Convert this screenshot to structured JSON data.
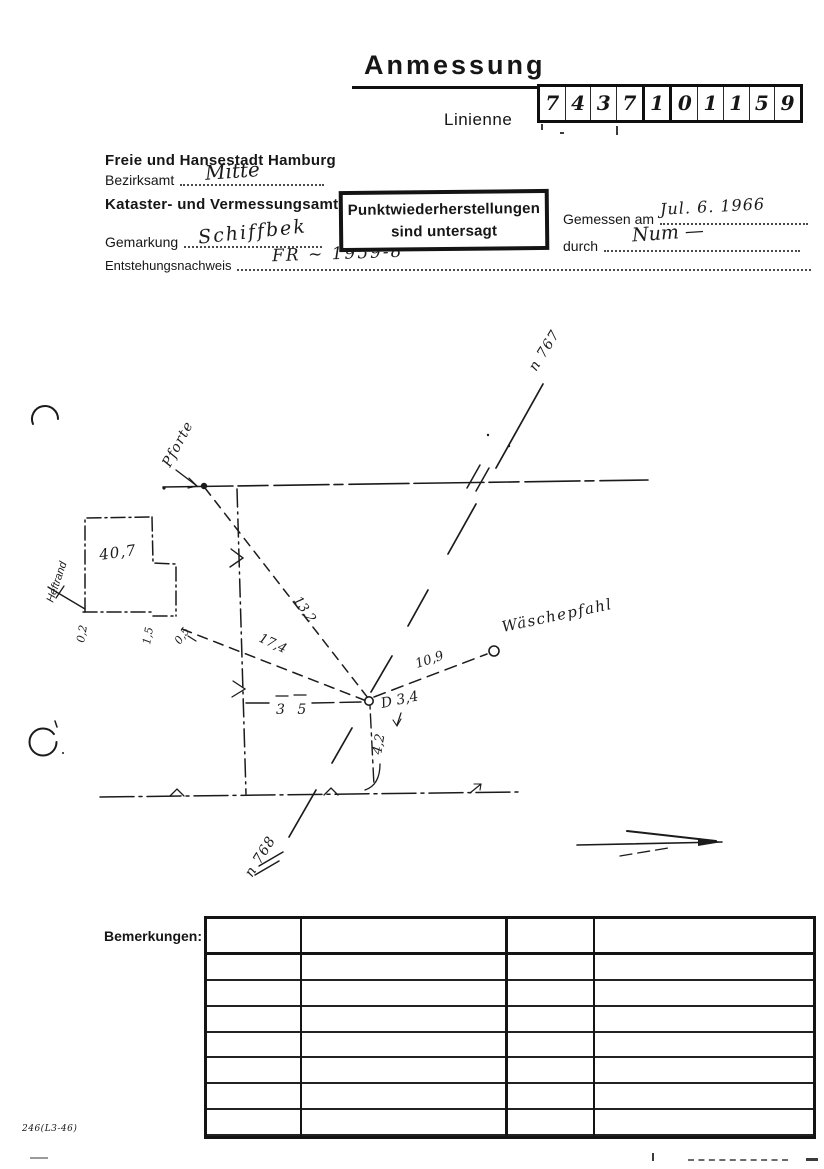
{
  "page": {
    "title": "Anmessung",
    "linien_label": "Linienne",
    "form_number": "246(L3-46)"
  },
  "point_number": {
    "digits": [
      "7",
      "4",
      "3",
      "7",
      "1",
      "0",
      "1",
      "1",
      "5",
      "9"
    ]
  },
  "header": {
    "city": "Freie und Hansestadt Hamburg",
    "bezirksamt": {
      "label": "Bezirksamt",
      "value": "Mitte"
    },
    "amt": "Kataster- und Vermessungsamt",
    "gemarkung": {
      "label": "Gemarkung",
      "value": "Schiffbek"
    },
    "entstehungsnachweis": {
      "label": "Entstehungsnachweis",
      "value": "FR ~ 1959-8"
    },
    "gemessen_am": {
      "label": "Gemessen am",
      "value": "Jul. 6. 1966"
    },
    "durch": {
      "label": "durch",
      "value": "Num —"
    },
    "stamp": {
      "line1": "Punktwiederherstellungen",
      "line2": "sind untersagt"
    }
  },
  "sketch": {
    "labels": {
      "pforte": "Pforte",
      "heftrand": "Heftrand",
      "line_upper": "n 767",
      "line_lower": "n 768",
      "waeschepfahl": "Wäschepfahl",
      "building_area": "40,7",
      "point_label": "D 3,4"
    },
    "measurements": {
      "dist_gate": "13,2",
      "dist_corner": "17,4",
      "dist_offset": "3 5",
      "dist_pole": "10,9",
      "dist_down": "4,2",
      "edge_offsets": [
        "0,2",
        "1,5",
        "0,5"
      ]
    }
  },
  "remarks": {
    "label": "Bemerkungen:",
    "columns": 4,
    "rows": 8
  }
}
